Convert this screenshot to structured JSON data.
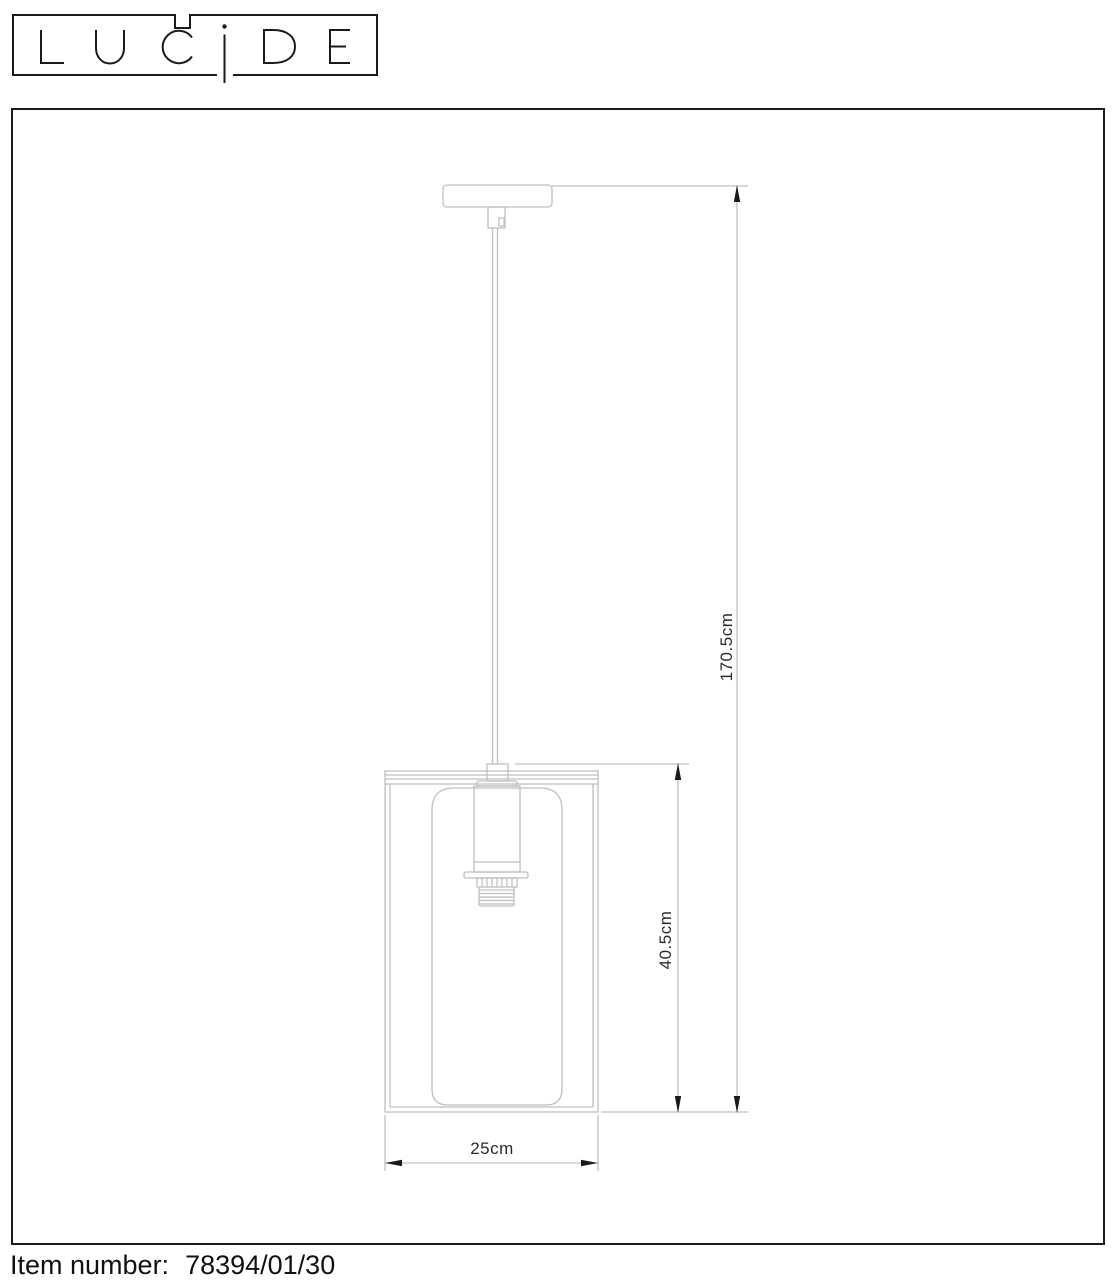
{
  "brand": "LUCIDE",
  "drawing": {
    "dimensions": {
      "total_height": "170.5cm",
      "shade_height": "40.5cm",
      "shade_width": "25cm"
    }
  },
  "footer": {
    "label": "Item number:",
    "value": "78394/01/30"
  },
  "colors": {
    "ink": "#1a1a1a",
    "drawing_line": "#bfbfbf",
    "dimension_line": "#b3b3b3",
    "label_text": "#2b2b2b"
  }
}
